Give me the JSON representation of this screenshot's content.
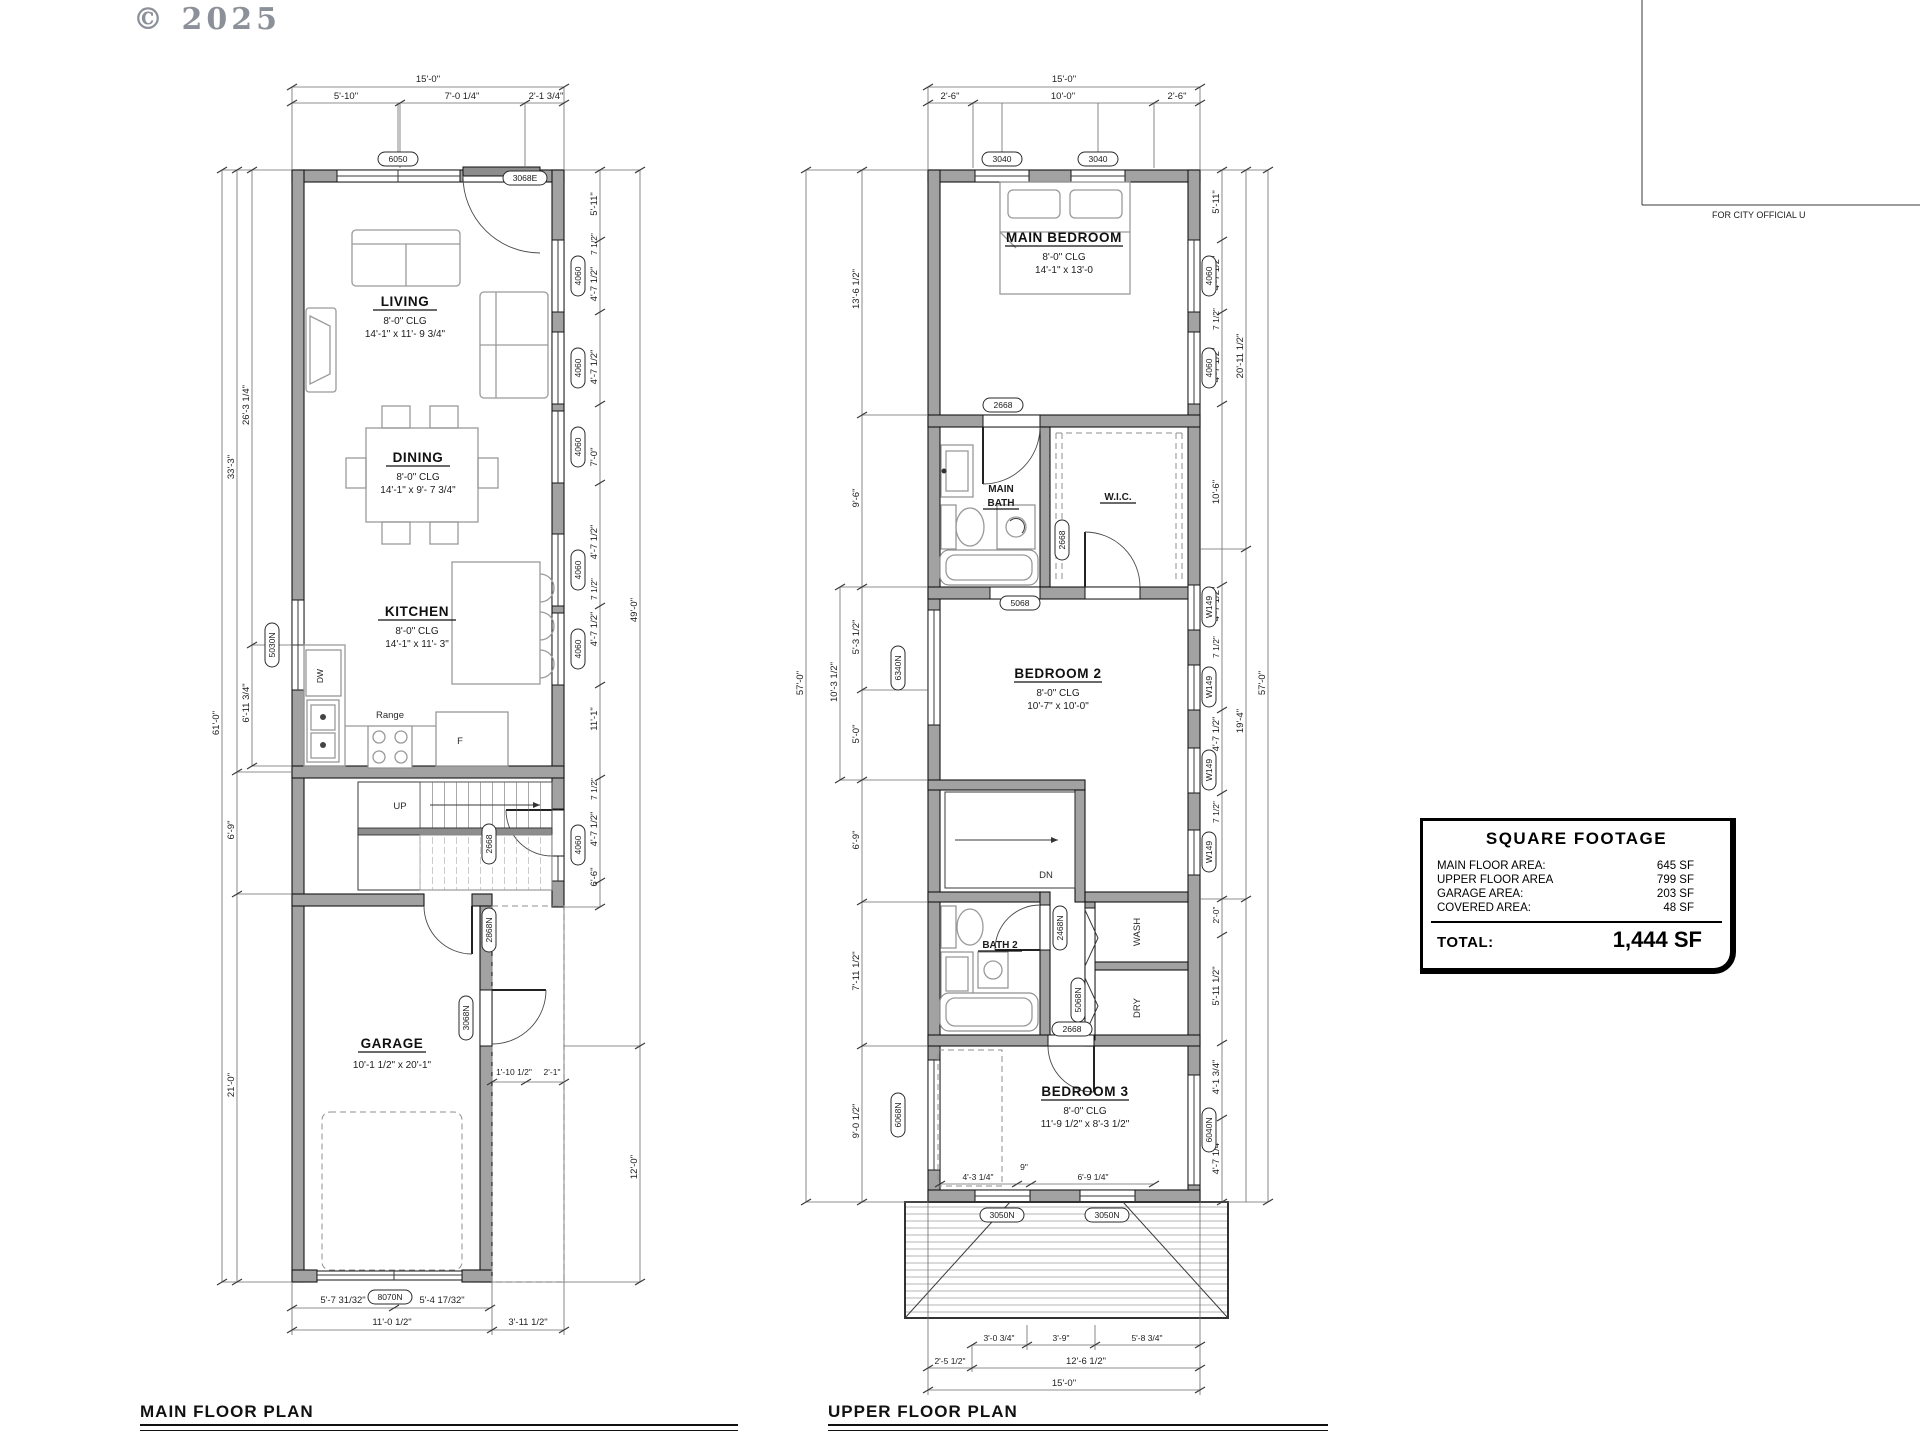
{
  "page": {
    "copyright": "© 2025",
    "corner_note": "FOR CITY OFFICIAL U"
  },
  "main_plan": {
    "title": "MAIN FLOOR PLAN",
    "rooms": {
      "living": {
        "name": "LIVING",
        "clg": "8'-0\" CLG",
        "size": "14'-1\" x 11'- 9 3/4\""
      },
      "dining": {
        "name": "DINING",
        "clg": "8'-0\" CLG",
        "size": "14'-1\" x 9'- 7 3/4\""
      },
      "kitchen": {
        "name": "KITCHEN",
        "clg": "8'-0\" CLG",
        "size": "14'-1\" x 11'- 3\""
      },
      "garage": {
        "name": "GARAGE",
        "size": "10'-1 1/2\" x 20'-1\""
      }
    },
    "labels": {
      "dw": "DW",
      "range": "Range",
      "fridge": "F",
      "up": "UP"
    },
    "tags": {
      "top_window": "6050",
      "entry_door": "3068E",
      "kitchen_window": "5030N",
      "hall_door": "2668",
      "garage_entry": "2868N",
      "side_door": "3068N",
      "overhead_door": "8070N",
      "side_window": "4060"
    },
    "dims": {
      "top": [
        "15'-0\"",
        "5'-10\"",
        "7'-0 1/4\"",
        "2'-1 3/4\""
      ],
      "left": [
        "26'-3 1/4\"",
        "6'-11 3/4\"",
        "33'-3\"",
        "6'-9\"",
        "21'-0\"",
        "61'-0\""
      ],
      "right": [
        "5'-11\"",
        "7 1/2\"",
        "4'-7 1/2\"",
        "4'-7 1/2\"",
        "7'-0\"",
        "4'-7 1/2\"",
        "7 1/2\"",
        "4'-7 1/2\"",
        "11'-1\"",
        "7 1/2\"",
        "4'-7 1/2\"",
        "6'-6\"",
        "49'-0\"",
        "12'-0\""
      ],
      "bottom": [
        "5'-7 31/32\"",
        "5'-4 17/32\"",
        "11'-0 1/2\"",
        "3'-11 1/2\""
      ],
      "misc": [
        "1'-10 1/2\"",
        "2'-1\""
      ]
    }
  },
  "upper_plan": {
    "title": "UPPER FLOOR PLAN",
    "rooms": {
      "main_bedroom": {
        "name": "MAIN BEDROOM",
        "clg": "8'-0\" CLG",
        "size": "14'-1\" x 13'-0"
      },
      "main_bath": {
        "line1": "MAIN",
        "line2": "BATH"
      },
      "wic": {
        "name": "W.I.C."
      },
      "bedroom2": {
        "name": "BEDROOM 2",
        "clg": "8'-0\" CLG",
        "size": "10'-7\" x 10'-0\""
      },
      "bath2": {
        "name": "BATH 2"
      },
      "bedroom3": {
        "name": "BEDROOM 3",
        "clg": "8'-0\" CLG",
        "size": "11'-9 1/2\" x 8'-3 1/2\""
      }
    },
    "labels": {
      "dn": "DN",
      "wash": "WASH",
      "dry": "DRY"
    },
    "tags": {
      "bedroom_window": "3040",
      "door_2668": "2668",
      "opening": "5068",
      "stair_window": "6340N",
      "wall_window": "W149",
      "bath2_door": "2468N",
      "laundry_door": "5068N",
      "closet_window": "6068N",
      "bed3_window": "6040N",
      "deck_window": "3050N",
      "bed_window_right": "4060"
    },
    "dims": {
      "top": [
        "15'-0\"",
        "2'-6\"",
        "10'-0\"",
        "2'-6\""
      ],
      "left": [
        "13'-6 1/2\"",
        "9'-6\"",
        "5'-3 1/2\"",
        "5'-0\"",
        "10'-3 1/2\"",
        "6'-9\"",
        "7'-11 1/2\"",
        "9'-0 1/2\"",
        "57'-0\""
      ],
      "right": [
        "5'-11\"",
        "4'-7 1/2\"",
        "7 1/2\"",
        "4'-7 1/2\"",
        "10'-6\"",
        "4'-7 1/2\"",
        "7 1/2\"",
        "4'-7 1/2\"",
        "7 1/2\"",
        "20'-11 1/2\"",
        "19'-4\"",
        "2'-0\"",
        "5'-11 1/2\"",
        "4'-1 3/4\"",
        "4'-7 1/4\"",
        "57'-0\""
      ],
      "bottom": [
        "4'-3 1/4\"",
        "9\"",
        "6'-9 1/4\"",
        "3'-0 3/4\"",
        "3'-9\"",
        "5'-8 3/4\"",
        "2'-5 1/2\"",
        "12'-6 1/2\"",
        "15'-0\""
      ]
    }
  },
  "square_footage": {
    "title": "SQUARE FOOTAGE",
    "rows": [
      {
        "label": "MAIN FLOOR AREA:",
        "value": "645 SF"
      },
      {
        "label": "UPPER FLOOR AREA",
        "value": "799 SF"
      },
      {
        "label": "GARAGE AREA:",
        "value": "203 SF"
      },
      {
        "label": "COVERED AREA:",
        "value": "48 SF"
      }
    ],
    "total_label": "TOTAL:",
    "total_value": "1,444 SF"
  }
}
